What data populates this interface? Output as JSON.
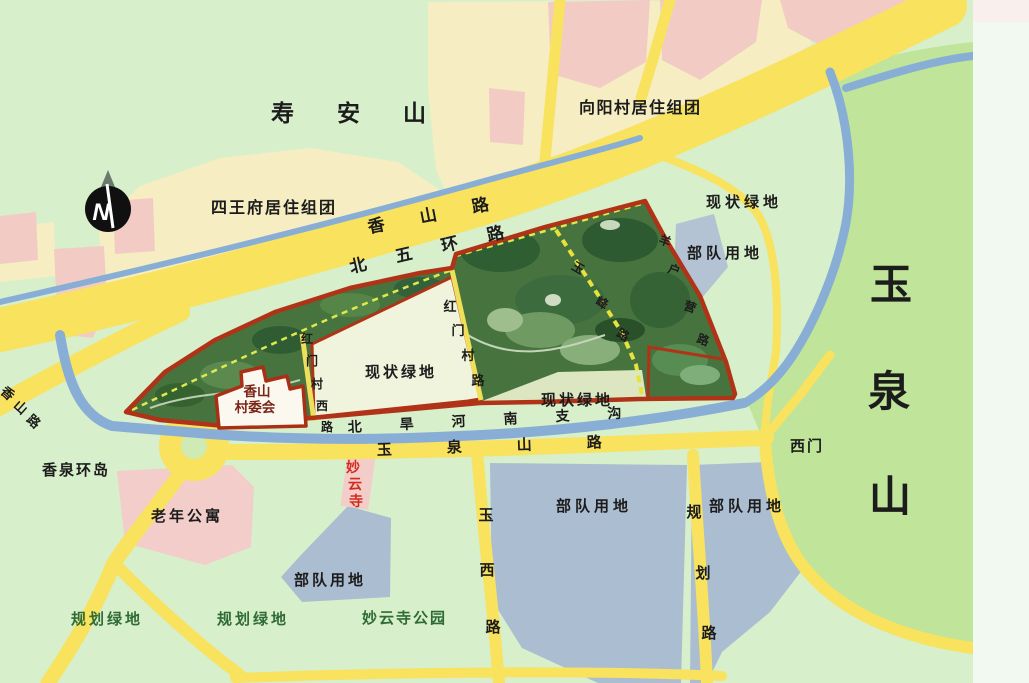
{
  "map": {
    "compass_letter": "N",
    "colors": {
      "background": "#d7efca",
      "mountain_green": "#bfe49a",
      "road_yellow": "#f8e25e",
      "water_blue": "#88aed6",
      "residential_cream": "#f6eec2",
      "residential_pink": "#f2cbc5",
      "military_gray": "#abbdd0",
      "site_border_red": "#b03318",
      "site_green": "#47743e",
      "planning_text_green": "#2f6b36",
      "temple_text_red": "#d42a1e",
      "village_text_maroon": "#7c2317"
    },
    "areas": {
      "shouanshan": "寿安山",
      "siwangfu": "四王府居住组团",
      "xiangyangcun": "向阳村居住组团",
      "yuquanshan_chars": [
        "玉",
        "泉",
        "山"
      ],
      "xianzhuang_lvdi_ne": "现状绿地",
      "xianzhuang_lvdi_west": "现状绿地",
      "xianzhuang_lvdi_se": "现状绿地",
      "budui_ne": "部队用地",
      "budui_center": "部队用地",
      "budui_south_left": "部队用地",
      "budui_south_right": "部队用地",
      "laonian_gongyu": "老年公寓",
      "guihua_lvdi_left": "规划绿地",
      "guihua_lvdi_center": "规划绿地",
      "miaoyunsi_gongyuan": "妙云寺公园",
      "miaoyunsi_chars": [
        "妙",
        "云",
        "寺"
      ],
      "cunweihui_line1": "香山",
      "cunweihui_line2": "村委会",
      "ximen": "西门",
      "xiangquan_huandao": "香泉环岛"
    },
    "roads": {
      "xiangshan_lu": "香山路",
      "beiwuhuan_lu": "北五环路",
      "xiangshan_lu_west_chars": [
        "香",
        "山",
        "路"
      ],
      "yuquanshan_lu": "玉泉山路",
      "beihanhe_nanzhigou": "北旱河南支沟",
      "hongmencun_xilu_chars": [
        "红",
        "门",
        "村",
        "西",
        "路"
      ],
      "hongmencun_lu_chars": [
        "红",
        "门",
        "村",
        "路"
      ],
      "yufeng_lu_chars": [
        "玉",
        "峰",
        "路"
      ],
      "yanghuying_lu_chars": [
        "羊",
        "户",
        "营",
        "路"
      ],
      "yuxi_lu_chars": [
        "玉",
        "西",
        "路"
      ],
      "guihua_lu_chars": [
        "规",
        "划",
        "路"
      ]
    }
  }
}
